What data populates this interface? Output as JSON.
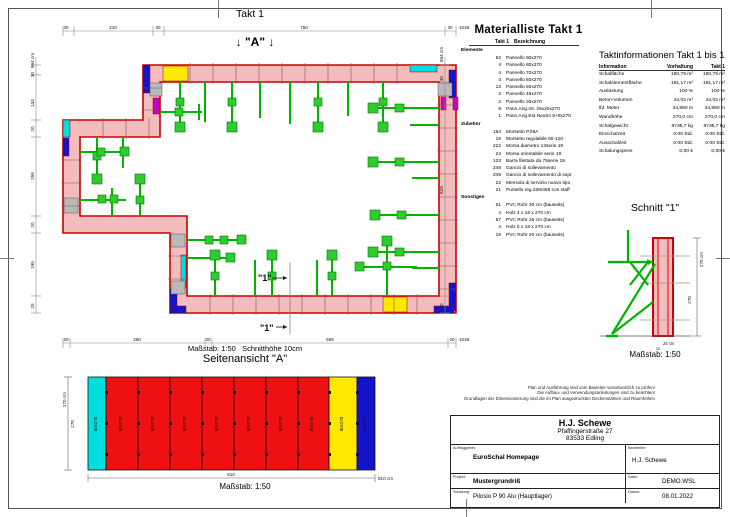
{
  "colors": {
    "wall_fill": "#f4bcbc",
    "wall_edge": "#cc0000",
    "accent_blue": "#1414cc",
    "accent_cyan": "#00dede",
    "accent_yellow": "#ffe800",
    "accent_magenta": "#cc00cc",
    "prop_green": "#00b400",
    "panel_red": "#ee1111"
  },
  "plan": {
    "title": "Takt 1",
    "marker_a": "↓ \"A\" ↓",
    "marker_1_inner": "\"1\"",
    "marker_1_outer": "\"1\"",
    "caption_scale": "Maßstab: 1:50",
    "caption_cut": "Schnitthöhe 10cm",
    "dims": {
      "top": [
        "30",
        "210",
        "30",
        "750",
        "30"
      ],
      "top_total": "1048 cm",
      "bottom": [
        "20",
        "360",
        "20",
        "665",
        "20"
      ],
      "bottom_total": "1048 cm",
      "left": [
        "30",
        "134",
        "20",
        "255",
        "20",
        "195",
        "25"
      ],
      "left_total": "694 cm",
      "right": [
        "30",
        "629",
        "20"
      ],
      "right_total": "694 cm"
    }
  },
  "seitenansicht": {
    "title": "Seitenansicht \"A\"",
    "dim_height": "270 cm",
    "dim_height2": "270",
    "dim_width": "810",
    "dim_width_total": "810 cm",
    "scale": "Maßstab: 1:50",
    "panels": [
      {
        "label": "50x270"
      },
      {
        "label": "90x270"
      },
      {
        "label": "90x270"
      },
      {
        "label": "90x270"
      },
      {
        "label": "90x270"
      },
      {
        "label": "90x270"
      },
      {
        "label": "90x270"
      },
      {
        "label": "90x270"
      },
      {
        "label": "80x270"
      },
      {
        "label": "50x270"
      }
    ]
  },
  "schnitt": {
    "title": "Schnitt \"1\"",
    "scale": "Maßstab: 1:50",
    "dim_height": "270 cm",
    "dim_height2": "270",
    "dim_w1": "25 cm",
    "dim_w2": "20"
  },
  "materialliste": {
    "title": "Materialliste  Takt 1",
    "col_qty": "Takt 1",
    "col_desc": "Bezeichnung",
    "sections": [
      {
        "name": "Elemente",
        "items": [
          [
            "52",
            "Pannello 90x270"
          ],
          [
            "4",
            "Pannello 80x270"
          ],
          [
            "4",
            "Pannello 70x270"
          ],
          [
            "4",
            "Pannello 60x270"
          ],
          [
            "13",
            "Pannello 50x270"
          ],
          [
            "3",
            "Pannello 45x270"
          ],
          [
            "2",
            "Pannello 30x270"
          ],
          [
            "8",
            "Pann.Ang.Int. 25x20x270"
          ],
          [
            "1",
            "Pann.Ang.Est.Neutro 8+8x270"
          ]
        ]
      },
      {
        "name": "Zubehör",
        "items": [
          [
            "154",
            "Morsetto P.06A"
          ],
          [
            "16",
            "Morsetto regolabile 60-120"
          ],
          [
            "222",
            "Morsa diametro 13serie 19"
          ],
          [
            "24",
            "Morsa orientabile serie 19"
          ],
          [
            "123",
            "Barra filettata da 75serie 19"
          ],
          [
            "248",
            "Gancio di sollevamento"
          ],
          [
            "248",
            "Gancio di sollevamento di sopr"
          ],
          [
            "22",
            "Mensola di servizio nuovo tipo"
          ],
          [
            "21",
            "Puntello reg.208/368 con staff"
          ]
        ]
      },
      {
        "name": "Sonstiges",
        "items": [
          [
            "61",
            "PVC Rohr 30 cm (bauseits)"
          ],
          [
            "4",
            "Holz 4 x 18 x 270 cm"
          ],
          [
            "57",
            "PVC Rohr 25 cm (bauseits)"
          ],
          [
            "4",
            "Holz 5 x 18 x 270 cm"
          ],
          [
            "16",
            "PVC Rohr 20 cm (bauseits)"
          ]
        ]
      }
    ]
  },
  "taktinfo": {
    "title": "Taktinformationen  Takt 1 bis 1",
    "headers": [
      "Information",
      "Vorhaltung",
      "Takt 1"
    ],
    "rows": [
      [
        "Schalfläche",
        "180,79 m²",
        "180,79 m²"
      ],
      [
        "Schalelementfläche",
        "181,17 m²",
        "181,17 m²"
      ],
      [
        "Auslastung",
        "100 %",
        "100 %"
      ],
      [
        "Beton-Volumen",
        "24,02 m³",
        "24,02 m³"
      ],
      [
        "lfd. Meter",
        "34,880 m",
        "34,880 m"
      ],
      [
        "Wandhöhe",
        "270,0 cm",
        "270,0 cm"
      ],
      [
        "Schalgewicht",
        "8735,7 kg",
        "8735,7 kg"
      ],
      [
        "Einschalzeit",
        "0:00 Std.",
        "0:00 Std."
      ],
      [
        "Ausschalzeit",
        "0:00 Std.",
        "0:00 Std."
      ],
      [
        "Schalungspreis",
        "0,00 €",
        "0,00 €"
      ]
    ]
  },
  "disclaimer": {
    "line1": "Plan und Ausführung sind vom Bauleiter verantwortlich zu prüfen!",
    "line2": "Die Aufbau- und Verwendungsanleitungen sind zu beachten!",
    "line3": "Grundlagen der Dimensionierung sind die im Plan ausgedruckten Deckenstärken und Raumhöhen"
  },
  "titleblock": {
    "company": "H.J. Schewe",
    "street": "Pfaffingerstraße 27",
    "city": "83533 Edling",
    "auftraggeber_label": "Auftraggeber:",
    "auftraggeber": "EuroSchal Homepage",
    "bearbeiter_label": "Bearbeiter:",
    "bearbeiter": "H.J. Schewe",
    "projekt_label": "Projekt:",
    "projekt": "Mustergrundriß",
    "datei_label": "Datei:",
    "datei": "DEMO.WSL",
    "schalung_label": "Schalung:",
    "schalung": "Pilosio P 90 Alu (Hauptlager)",
    "datum_label": "Datum:",
    "datum": "08.01.2022"
  }
}
